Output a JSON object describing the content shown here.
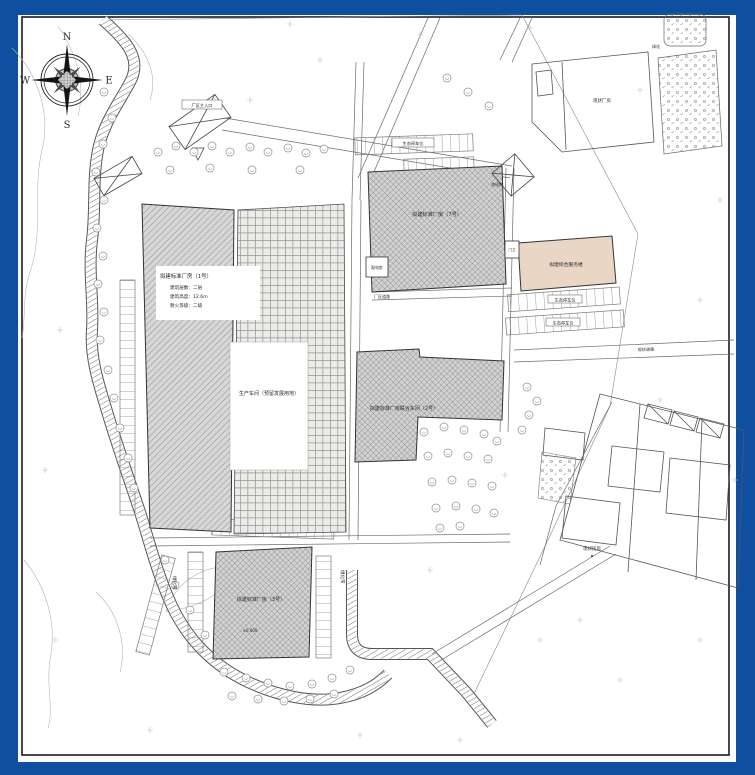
{
  "plan": {
    "compass": {
      "north": "N",
      "east": "E",
      "south": "S",
      "west": "W"
    },
    "buildings": {
      "workshop1": {
        "line1": "拟建标准厂房（1号）",
        "line2": "建筑层数：二层",
        "line3": "建筑高度：12.6m",
        "line4": "耐火等级：二级"
      },
      "reserve": {
        "name": "生产车间（预留发展用地）"
      },
      "workshop7": {
        "name": "拟建标准厂房（7号）"
      },
      "power": {
        "name": "配电房"
      },
      "office": {
        "name": "拟建综合服务楼"
      },
      "guard": {
        "name": "门卫"
      },
      "workshop2": {
        "name": "拟建标准厂房联合车间（2号）"
      },
      "workshop3": {
        "name": "拟建标准厂房（3号）",
        "level": "±0.000"
      },
      "existing": {
        "name": "现状民房"
      },
      "existing_factory": {
        "name": "现状厂房"
      }
    },
    "annotations": {
      "gate": "厂区主入口",
      "weighbridge": "地磅房",
      "parking_top": "生态停车位",
      "parking_right_1": "生态停车位",
      "parking_right_2": "生态停车位",
      "green_left": "绿化带",
      "green_bottom": "绿化带",
      "green_corner": "绿化",
      "road_right": "现状道路",
      "road_bottom": "厂区道路"
    },
    "colors": {
      "frame_blue": "#0e4fa0",
      "paper": "#ffffff",
      "office_fill": "#e9d6c4",
      "hatch_gray": "#d7d7d7"
    }
  }
}
